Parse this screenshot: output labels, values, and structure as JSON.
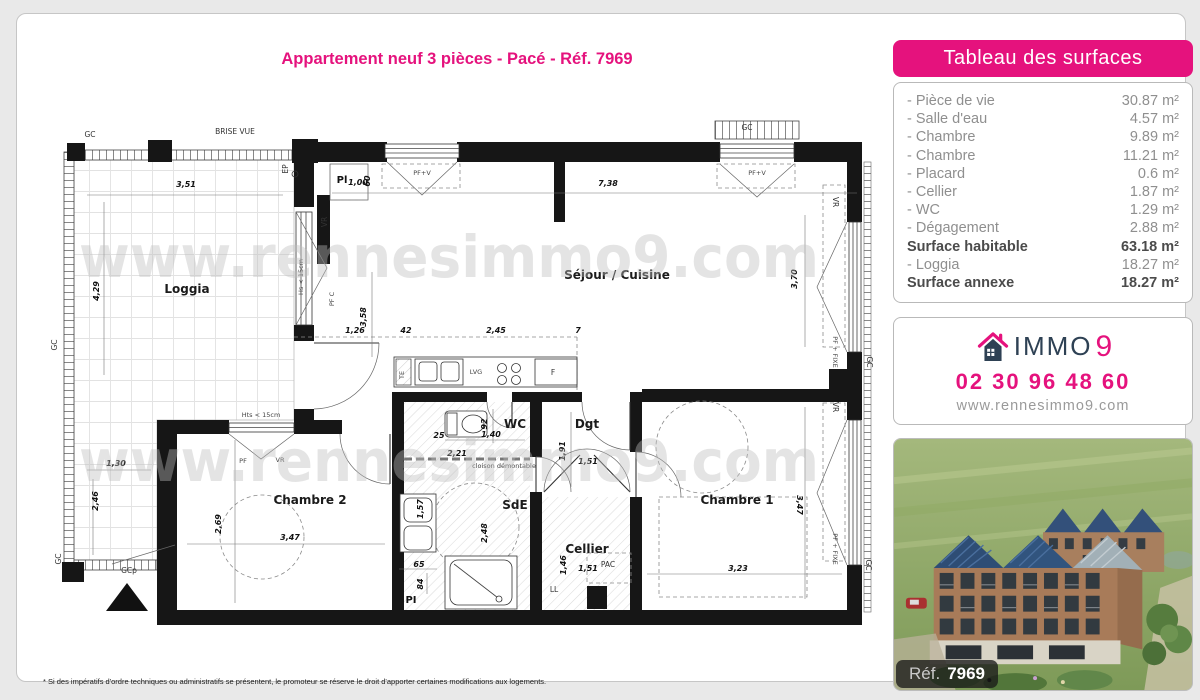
{
  "page": {
    "title": "Appartement neuf 3 pièces - Pacé - Réf. 7969",
    "footnote": "* Si des impératifs d'ordre techniques ou administratifs se présentent, le promoteur se réserve le droit d'apporter certaines modifications aux logements."
  },
  "colors": {
    "accent": "#e5127d",
    "navy": "#2e4154"
  },
  "surfaces": {
    "title": "Tableau des surfaces",
    "rows": [
      {
        "label": "- Pièce de vie",
        "value": "30.87 m²",
        "bold": false
      },
      {
        "label": "- Salle d'eau",
        "value": "4.57 m²",
        "bold": false
      },
      {
        "label": "- Chambre",
        "value": "9.89 m²",
        "bold": false
      },
      {
        "label": "- Chambre",
        "value": "11.21 m²",
        "bold": false
      },
      {
        "label": "- Placard",
        "value": "0.6 m²",
        "bold": false
      },
      {
        "label": "- Cellier",
        "value": "1.87 m²",
        "bold": false
      },
      {
        "label": "- WC",
        "value": "1.29 m²",
        "bold": false
      },
      {
        "label": "- Dégagement",
        "value": "2.88 m²",
        "bold": false
      },
      {
        "label": "Surface habitable",
        "value": "63.18 m²",
        "bold": true
      },
      {
        "label": "- Loggia",
        "value": "18.27 m²",
        "bold": false
      },
      {
        "label": "Surface annexe",
        "value": "18.27 m²",
        "bold": true
      }
    ]
  },
  "agency": {
    "brand_immo": "IMMO",
    "brand_9": "9",
    "phone": "02 30 96 48 60",
    "website": "www.rennesimmo9.com",
    "house_icon": "house-icon"
  },
  "photo": {
    "ref_label": "Réf.",
    "ref_number": "7969"
  },
  "plan": {
    "watermark": "www.rennesimmo9.com",
    "watermark_positions": [
      {
        "x": 32,
        "y": 170
      },
      {
        "x": 32,
        "y": 374
      }
    ],
    "labels": [
      {
        "t": "Loggia",
        "x": 140,
        "y": 186,
        "c": "room"
      },
      {
        "t": "Séjour / Cuisine",
        "x": 570,
        "y": 172,
        "c": "room"
      },
      {
        "t": "Chambre 2",
        "x": 263,
        "y": 397,
        "c": "room"
      },
      {
        "t": "Chambre 1",
        "x": 690,
        "y": 397,
        "c": "room"
      },
      {
        "t": "WC",
        "x": 468,
        "y": 321,
        "c": "room"
      },
      {
        "t": "Dgt",
        "x": 540,
        "y": 321,
        "c": "room"
      },
      {
        "t": "SdE",
        "x": 468,
        "y": 402,
        "c": "room"
      },
      {
        "t": "Cellier",
        "x": 540,
        "y": 446,
        "c": "room"
      },
      {
        "t": "GC",
        "x": 43,
        "y": 30,
        "c": "sm"
      },
      {
        "t": "BRISE VUE",
        "x": 188,
        "y": 27,
        "c": "sm"
      },
      {
        "t": "GC",
        "x": 700,
        "y": 23,
        "c": "sm"
      },
      {
        "t": "GC",
        "x": 10,
        "y": 238,
        "r": -90,
        "c": "sm"
      },
      {
        "t": "GC",
        "x": 14,
        "y": 452,
        "r": -90,
        "c": "sm"
      },
      {
        "t": "GC",
        "x": 820,
        "y": 255,
        "r": 90,
        "c": "sm"
      },
      {
        "t": "GC",
        "x": 819,
        "y": 458,
        "r": 90,
        "c": "sm"
      },
      {
        "t": "GCp",
        "x": 82,
        "y": 466,
        "c": "sm"
      },
      {
        "t": "EP",
        "x": 241,
        "y": 62,
        "r": -90,
        "c": "sm"
      },
      {
        "t": "Pl",
        "x": 295,
        "y": 76,
        "c": "lblb"
      },
      {
        "t": "1,00",
        "x": 311,
        "y": 78,
        "c": "dim"
      },
      {
        "t": "60",
        "x": 323,
        "y": 74,
        "r": -90,
        "c": "dim"
      },
      {
        "t": "VR",
        "x": 280,
        "y": 115,
        "r": -90,
        "c": "sm"
      },
      {
        "t": "Hs < 15cm",
        "x": 256,
        "y": 170,
        "r": -90,
        "c": "tiny"
      },
      {
        "t": "PF C",
        "x": 287,
        "y": 192,
        "r": -90,
        "c": "tiny"
      },
      {
        "t": "PF+V",
        "x": 375,
        "y": 68,
        "c": "tiny"
      },
      {
        "t": "PF+V",
        "x": 710,
        "y": 68,
        "c": "tiny"
      },
      {
        "t": "VR",
        "x": 786,
        "y": 95,
        "r": 90,
        "c": "sm"
      },
      {
        "t": "PF + FIXE",
        "x": 786,
        "y": 245,
        "r": 90,
        "c": "tiny"
      },
      {
        "t": "VR",
        "x": 786,
        "y": 300,
        "r": 90,
        "c": "sm"
      },
      {
        "t": "PF + FIXE",
        "x": 786,
        "y": 442,
        "r": 90,
        "c": "tiny"
      },
      {
        "t": "Hts < 15cm",
        "x": 214,
        "y": 310,
        "c": "tiny"
      },
      {
        "t": "PF",
        "x": 196,
        "y": 356,
        "c": "tiny"
      },
      {
        "t": "VR",
        "x": 233,
        "y": 355,
        "c": "tiny"
      },
      {
        "t": "TE",
        "x": 357,
        "y": 268,
        "r": -90,
        "c": "tiny"
      },
      {
        "t": "LVG",
        "x": 429,
        "y": 267,
        "c": "tiny"
      },
      {
        "t": "F",
        "x": 506,
        "y": 268,
        "c": "sm"
      },
      {
        "t": "2,21",
        "x": 410,
        "y": 349,
        "c": "dim"
      },
      {
        "t": "cloison démontable",
        "x": 457,
        "y": 361,
        "c": "tiny"
      },
      {
        "t": "PAC",
        "x": 561,
        "y": 460,
        "c": "sm"
      },
      {
        "t": "LL",
        "x": 507,
        "y": 485,
        "c": "sm"
      },
      {
        "t": "PI",
        "x": 364,
        "y": 496,
        "c": "lblb"
      },
      {
        "t": "3,51",
        "x": 139,
        "y": 80,
        "c": "dim"
      },
      {
        "t": "4,29",
        "x": 52,
        "y": 184,
        "r": -90,
        "c": "dim"
      },
      {
        "t": "7,38",
        "x": 561,
        "y": 79,
        "c": "dim"
      },
      {
        "t": "3,70",
        "x": 750,
        "y": 172,
        "r": -90,
        "c": "dim"
      },
      {
        "t": "3,58",
        "x": 319,
        "y": 210,
        "r": -90,
        "c": "dim"
      },
      {
        "t": "1,26",
        "x": 308,
        "y": 226,
        "c": "dim"
      },
      {
        "t": "42",
        "x": 359,
        "y": 226,
        "c": "dim"
      },
      {
        "t": "2,45",
        "x": 449,
        "y": 226,
        "c": "dim"
      },
      {
        "t": "7",
        "x": 531,
        "y": 226,
        "c": "dim"
      },
      {
        "t": "1,30",
        "x": 69,
        "y": 359,
        "c": "dim"
      },
      {
        "t": "2,46",
        "x": 51,
        "y": 394,
        "r": -90,
        "c": "dim"
      },
      {
        "t": "2,69",
        "x": 174,
        "y": 417,
        "r": -90,
        "c": "dim"
      },
      {
        "t": "3,47",
        "x": 243,
        "y": 433,
        "c": "dim"
      },
      {
        "t": "92",
        "x": 440,
        "y": 317,
        "r": -90,
        "c": "dim"
      },
      {
        "t": "25",
        "x": 392,
        "y": 331,
        "c": "dim"
      },
      {
        "t": "1,40",
        "x": 444,
        "y": 330,
        "c": "dim"
      },
      {
        "t": "1,91",
        "x": 518,
        "y": 344,
        "r": -90,
        "c": "dim"
      },
      {
        "t": "1,51",
        "x": 541,
        "y": 357,
        "c": "dim"
      },
      {
        "t": "1,57",
        "x": 376,
        "y": 402,
        "r": -90,
        "c": "dim"
      },
      {
        "t": "2,48",
        "x": 440,
        "y": 426,
        "r": -90,
        "c": "dim"
      },
      {
        "t": "65",
        "x": 372,
        "y": 460,
        "c": "dim"
      },
      {
        "t": "84",
        "x": 376,
        "y": 477,
        "r": -90,
        "c": "dim"
      },
      {
        "t": "1,46",
        "x": 519,
        "y": 458,
        "r": -90,
        "c": "dim"
      },
      {
        "t": "1,51",
        "x": 541,
        "y": 464,
        "c": "dim"
      },
      {
        "t": "3,23",
        "x": 691,
        "y": 464,
        "c": "dim"
      },
      {
        "t": "3,47",
        "x": 750,
        "y": 398,
        "r": 90,
        "c": "dim"
      }
    ]
  }
}
